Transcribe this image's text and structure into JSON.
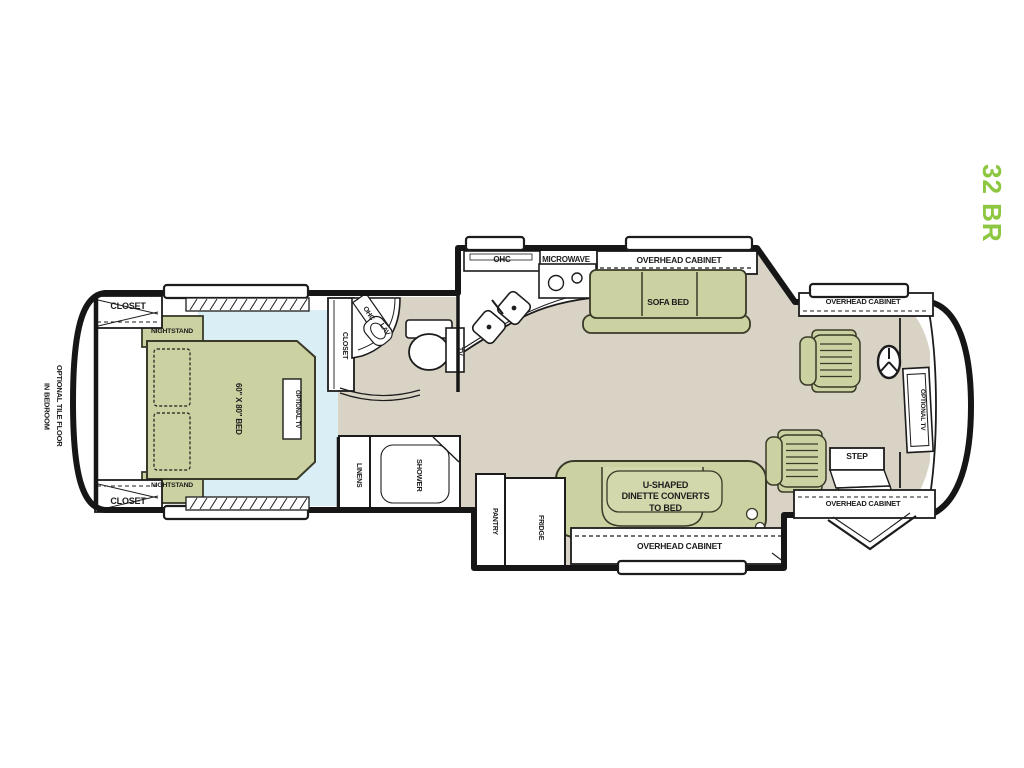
{
  "model": {
    "label": "32 BR"
  },
  "side_note": {
    "text": "OPTIONAL TILE FLOOR\nIN BEDROOM"
  },
  "bedroom": {
    "closet_top_label": "CLOSET",
    "closet_bottom_label": "CLOSET",
    "closet_side_label": "CLOSET",
    "nightstand_top_label": "NIGHTSTAND",
    "nightstand_bottom_label": "NIGHTSTAND",
    "bed_label": "60\" X 80\" BED",
    "optional_tv_label": "OPTIONAL TV"
  },
  "bath": {
    "ohc_label": "OHC",
    "lav_label": "LAV",
    "tv_label": "TV",
    "linens_label": "LINENS",
    "shower_label": "SHOWER"
  },
  "kitchen": {
    "ohc_label": "OHC",
    "microwave_label": "MICROWAVE",
    "overhead_cabinet_label": "OVERHEAD CABINET",
    "sofa_bed_label": "SOFA BED",
    "pantry_label": "PANTRY",
    "fridge_label": "FRIDGE"
  },
  "dinette": {
    "label": "U-SHAPED\nDINETTE CONVERTS\nTO BED",
    "overhead_cabinet_label": "OVERHEAD CABINET"
  },
  "cab": {
    "overhead_cabinet_top_label": "OVERHEAD CABINET",
    "overhead_cabinet_bottom_label": "OVERHEAD CABINET",
    "optional_tv_label": "OPTIONAL TV",
    "step_label": "STEP"
  },
  "colors": {
    "accent_green": "#8dc63f",
    "furniture_green": "#cbd1a0",
    "furniture_green_light": "#d3d8ac",
    "bedroom_floor": "#d9eef5",
    "main_floor": "#d8d3c5",
    "wall": "#161616"
  }
}
